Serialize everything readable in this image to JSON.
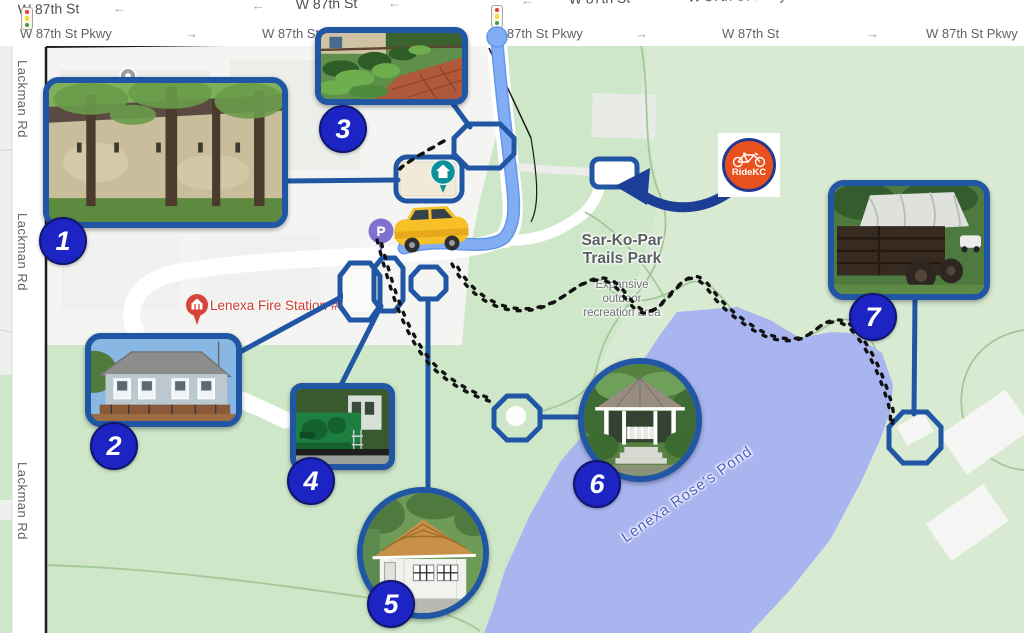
{
  "streets": {
    "row1_labels": [
      "W 87th St",
      "W 87th St",
      "W 87th St",
      "W 87th St Pkwy",
      "W 87th St"
    ],
    "row2_labels": [
      "W 87th St Pkwy",
      "W 87th St Pkwy",
      "W 87th St Pkwy",
      "W 87th St",
      "W 87th St Pkwy"
    ],
    "left_road": "Lackman Rd",
    "arrow_left": "←",
    "arrow_right": "→"
  },
  "park": {
    "name_line1": "Sar-Ko-Par",
    "name_line2": "Trails Park",
    "subtitle_line1": "Expansive",
    "subtitle_line2": "outdoor",
    "subtitle_line3": "recreation area"
  },
  "pond": {
    "label": "Lenexa Rose's Pond"
  },
  "fire_station": {
    "label": "Lenexa Fire Station #2"
  },
  "parking": {
    "letter": "P"
  },
  "ridekc": {
    "label": "RideKC"
  },
  "badges": [
    "1",
    "2",
    "3",
    "4",
    "5",
    "6",
    "7"
  ],
  "icons": {
    "traffic_light": "traffic-light-icon",
    "fire_station_pin": "fire-station-pin",
    "parking_pin": "parking-pin",
    "home_pin": "park-office-pin",
    "gray_pin": "lot-pin",
    "car": "car-icon",
    "bike": "bike-icon",
    "route_start": "route-start-dot",
    "arrow": "parking-direction-arrow",
    "footprints": "walking-trail-footprints"
  },
  "colors": {
    "annotation_blue": "#2156a5",
    "badge_blue": "#1c25c4",
    "navy_arrow": "#1c3e96",
    "ridekc_orange": "#e8511d",
    "route_blue": "#7fabf3",
    "pond_fill": "#a9b5ef",
    "park_green": "#cde7c8",
    "fire_red": "#cf3a30",
    "pond_text": "#515cc5"
  }
}
